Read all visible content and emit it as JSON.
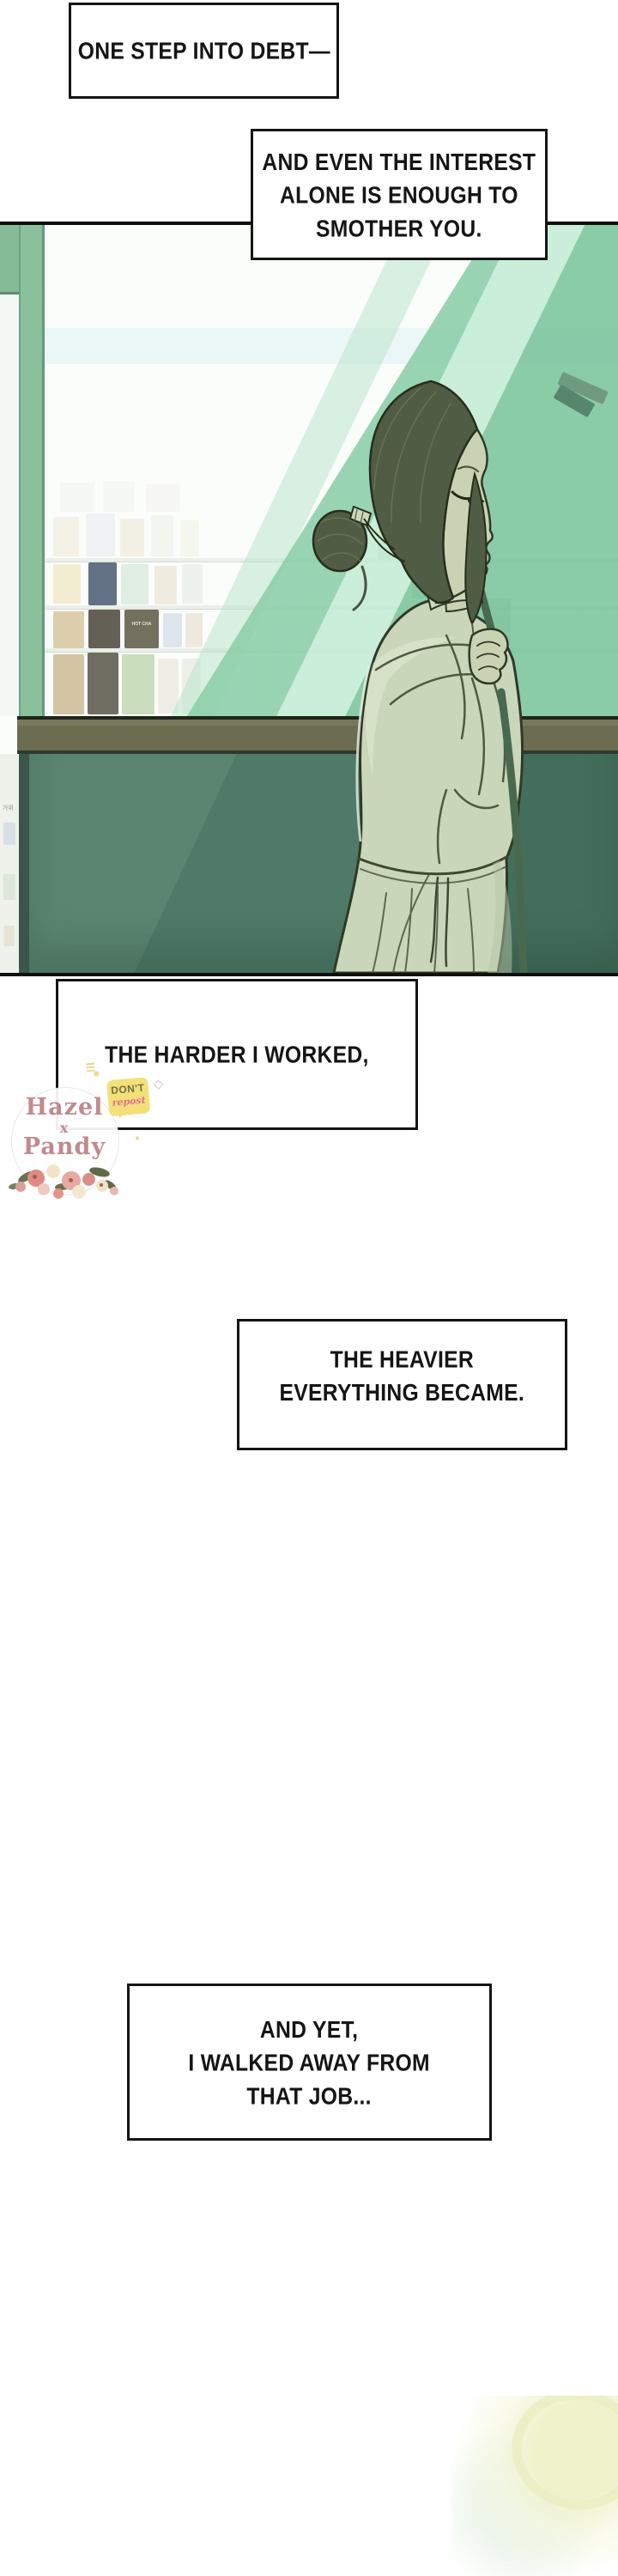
{
  "narration": {
    "boxes": [
      {
        "name": "box-1",
        "lines": [
          "ONE STEP INTO DEBT—"
        ]
      },
      {
        "name": "box-2",
        "lines": [
          "AND EVEN THE INTEREST",
          "ALONE IS ENOUGH TO",
          "SMOTHER YOU."
        ]
      },
      {
        "name": "box-3",
        "lines": [
          "THE HARDER I WORKED,"
        ]
      },
      {
        "name": "box-4",
        "lines": [
          "THE HEAVIER",
          "EVERYTHING BECAME."
        ]
      },
      {
        "name": "box-5",
        "lines": [
          "AND YET,",
          "I WALKED AWAY FROM",
          "THAT JOB..."
        ]
      }
    ]
  },
  "watermark": {
    "title_line1": "Hazel",
    "title_line2": "x",
    "title_line3": "Pandy",
    "badge": {
      "line1": "DON'T",
      "line2": "repost"
    }
  },
  "panel": {
    "shelf_cup_label": "HOT CHA",
    "under_counter_label": "가위"
  },
  "colors": {
    "frame_green": "#8ac09c",
    "mint_streak": "#9ed9b7",
    "counter_olive": "#6b6c50",
    "wall_teal": "#4e7a67",
    "hair": "#515c44",
    "skin": "#c9d2b2",
    "clothing": "#c9d6ba",
    "strap": "#49694f",
    "text_ink": "#151515",
    "watermark_pink": "#c08a8e",
    "badge_yellow": "#f4e07a"
  }
}
